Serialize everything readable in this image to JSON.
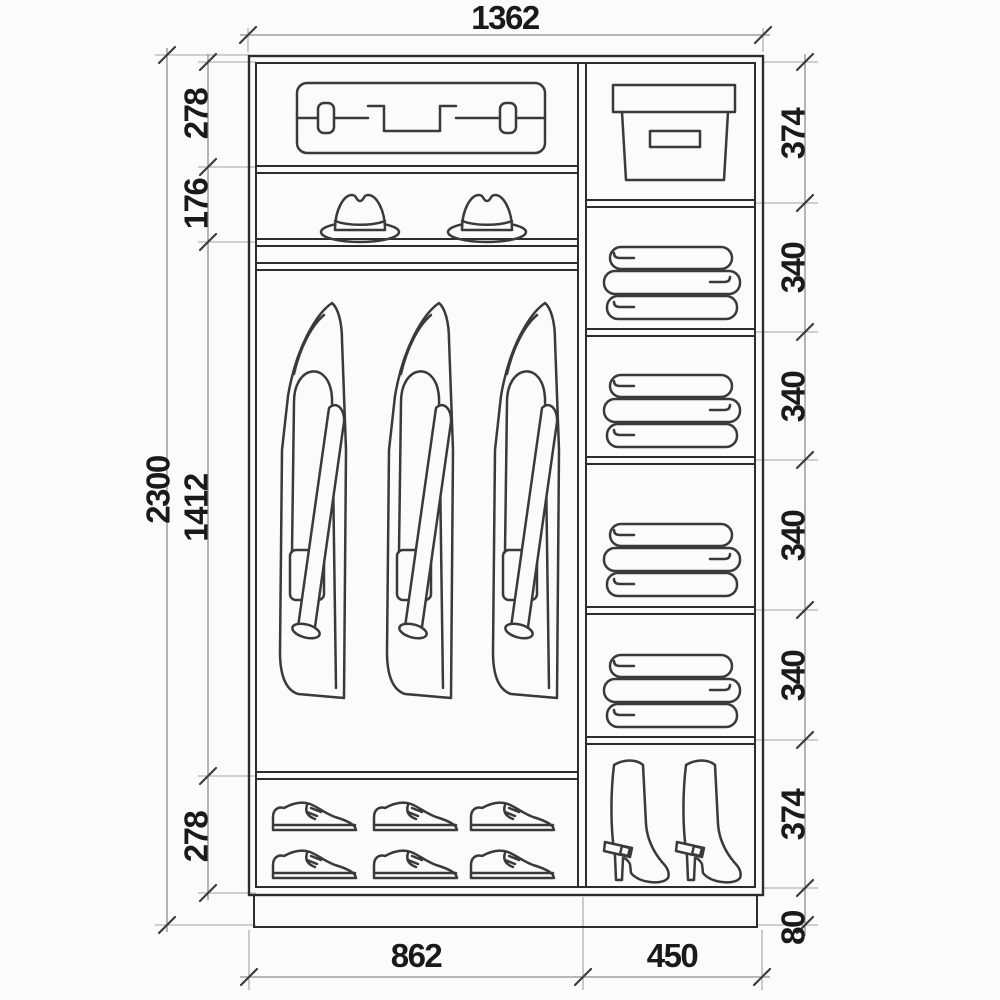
{
  "colors": {
    "background": "#fbfbfb",
    "cabinet_line": "#2d2d2d",
    "icon_line": "#3a3a3a",
    "dimension_line": "#8e8e8e",
    "text": "#1a1a1a"
  },
  "dims": {
    "width_total": "1362",
    "height_total": "2300",
    "left": [
      "278",
      "176",
      "1412",
      "278"
    ],
    "right": [
      "374",
      "340",
      "340",
      "340",
      "340",
      "374",
      "80"
    ],
    "bottom": [
      "862",
      "450"
    ]
  },
  "icons": {
    "suitcase": "suitcase-icon",
    "hat": "hat-icon",
    "coat": "coat-icon",
    "shoe": "shoe-icon",
    "storage_box": "storage-box-icon",
    "folded_linen": "folded-linen-icon",
    "boot": "boot-icon"
  }
}
